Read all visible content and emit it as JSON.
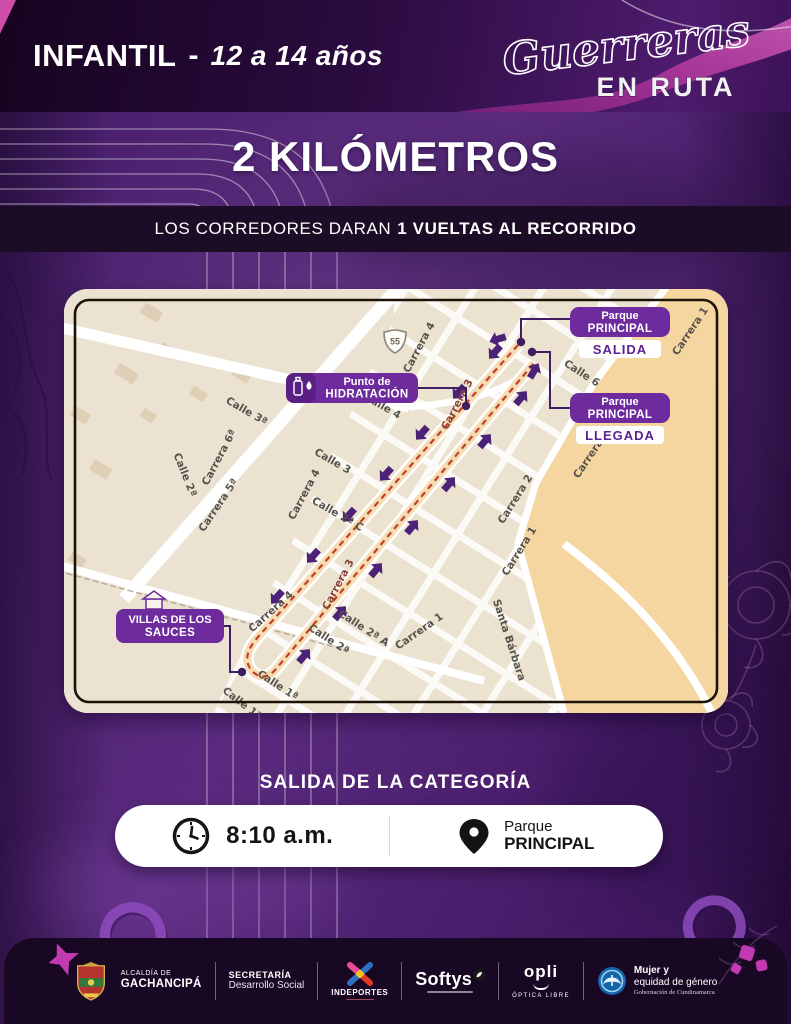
{
  "header": {
    "category": "INFANTIL",
    "separator": "-",
    "age_range": "12 a 14 años",
    "logo": {
      "script": "Guerreras",
      "subtitle": "EN RUTA"
    }
  },
  "distance_title": "2 KILÓMETROS",
  "laps_line": {
    "normal": "LOS CORREDORES DARAN",
    "bold": "1 VUELTAS AL RECORRIDO"
  },
  "map": {
    "route_shield": "55",
    "salida": {
      "line1": "Parque",
      "line2": "PRINCIPAL",
      "tag": "SALIDA"
    },
    "llegada": {
      "line1": "Parque",
      "line2": "PRINCIPAL",
      "tag": "LLEGADA"
    },
    "hidratacion": {
      "line1": "Punto de",
      "line2": "HIDRATACIÓN"
    },
    "villas": {
      "line1": "VILLAS DE LOS",
      "line2": "SAUCES"
    },
    "streets": [
      {
        "label": "Calle 3ª",
        "x": 181,
        "y": 125,
        "r": 30
      },
      {
        "label": "Carrera 6ª",
        "x": 158,
        "y": 170,
        "r": -62
      },
      {
        "label": "Calle 2ª",
        "x": 118,
        "y": 187,
        "r": 68
      },
      {
        "label": "Carrera 5ª",
        "x": 157,
        "y": 218,
        "r": -56
      },
      {
        "label": "Calle 3",
        "x": 267,
        "y": 175,
        "r": 30
      },
      {
        "label": "Carrera 4",
        "x": 243,
        "y": 207,
        "r": -62
      },
      {
        "label": "Calle 2ª C",
        "x": 272,
        "y": 228,
        "r": 30
      },
      {
        "label": "Carrera 4",
        "x": 358,
        "y": 60,
        "r": -62
      },
      {
        "label": "Calle 4",
        "x": 317,
        "y": 120,
        "r": 30
      },
      {
        "label": "Calle 6",
        "x": 516,
        "y": 87,
        "r": 33
      },
      {
        "label": "Carrera 1",
        "x": 629,
        "y": 44,
        "r": -56
      },
      {
        "label": "Carrera 2",
        "x": 454,
        "y": 212,
        "r": -58
      },
      {
        "label": "Carrera 2",
        "x": 530,
        "y": 167,
        "r": -56
      },
      {
        "label": "Carrera 1",
        "x": 458,
        "y": 264,
        "r": -58
      },
      {
        "label": "Carrera 3",
        "x": 396,
        "y": 117,
        "r": -62,
        "cls": "red"
      },
      {
        "label": "Carrera 3",
        "x": 277,
        "y": 297,
        "r": -62,
        "cls": "red"
      },
      {
        "label": "Carrera 4",
        "x": 209,
        "y": 325,
        "r": -42
      },
      {
        "label": "Calle 2ª",
        "x": 263,
        "y": 353,
        "r": 33
      },
      {
        "label": "Calle 2ª A",
        "x": 298,
        "y": 342,
        "r": 33
      },
      {
        "label": "Calle 1ª",
        "x": 212,
        "y": 399,
        "r": 33
      },
      {
        "label": "Calle 1ª",
        "x": 176,
        "y": 417,
        "r": 38
      },
      {
        "label": "Santa Bárbara",
        "x": 442,
        "y": 352,
        "r": 72
      },
      {
        "label": "Carrera 1",
        "x": 357,
        "y": 345,
        "r": -35
      }
    ]
  },
  "departure": {
    "heading": "SALIDA DE LA CATEGORÍA",
    "time": "8:10 a.m.",
    "place_line1": "Parque",
    "place_line2": "PRINCIPAL"
  },
  "footer": {
    "alcaldia": {
      "line1": "ALCALDÍA DE",
      "line2": "GACHANCIPÁ"
    },
    "secretaria": {
      "line1": "SECRETARÍA",
      "line2": "Desarrollo Social"
    },
    "indeportes": "INDEPORTES",
    "softys": "Softys",
    "opli": {
      "name": "opli",
      "subtitle": "ÓPTICA LIBRE"
    },
    "mujer": {
      "line1": "Mujer y",
      "line2": "equidad de género",
      "line3": "Gobernación de Cundinamarca"
    }
  },
  "colors": {
    "accent_purple": "#6d2b9e",
    "route_red": "#c2402f",
    "arrow_purple": "#4c2178",
    "map_orange": "#f5d6a0",
    "ribbon_magenta": "#b23a9c",
    "band_dark": "#1c0c26"
  }
}
